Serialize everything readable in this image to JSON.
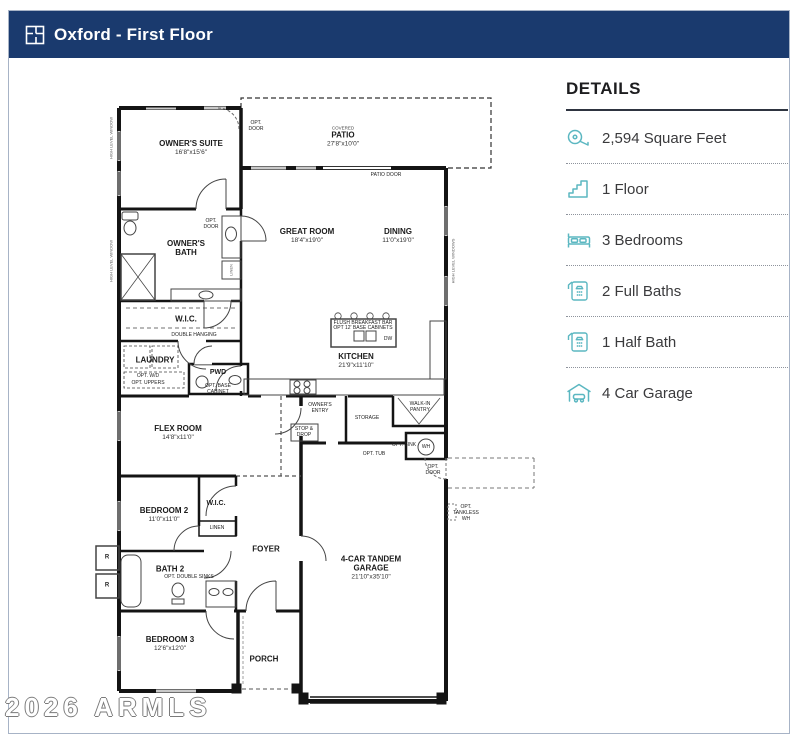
{
  "header": {
    "title": "Oxford - First Floor"
  },
  "details": {
    "heading": "DETAILS",
    "accent_color": "#5bb7c1",
    "items": [
      {
        "icon": "tape-measure-icon",
        "label": "2,594 Square Feet"
      },
      {
        "icon": "stairs-icon",
        "label": "1 Floor"
      },
      {
        "icon": "bed-icon",
        "label": "3 Bedrooms"
      },
      {
        "icon": "shower-icon",
        "label": "2 Full Baths"
      },
      {
        "icon": "shower-icon",
        "label": "1 Half Bath"
      },
      {
        "icon": "garage-icon",
        "label": "4 Car Garage"
      }
    ]
  },
  "floorplan": {
    "rooms": [
      {
        "name": "OWNER'S SUITE",
        "dims": "16'8\"x15'6\""
      },
      {
        "name": "PATIO",
        "dims": "27'8\"x10'0\"",
        "prefix": "COVERED"
      },
      {
        "name": "GREAT ROOM",
        "dims": "18'4\"x19'0\""
      },
      {
        "name": "DINING",
        "dims": "11'0\"x19'0\""
      },
      {
        "name": "OWNER'S BATH"
      },
      {
        "name": "W.I.C."
      },
      {
        "name": "LAUNDRY"
      },
      {
        "name": "PWD"
      },
      {
        "name": "KITCHEN",
        "dims": "21'9\"x11'10\""
      },
      {
        "name": "FLEX ROOM",
        "dims": "14'8\"x11'0\""
      },
      {
        "name": "BEDROOM 2",
        "dims": "11'0\"x11'0\""
      },
      {
        "name": "W.I.C."
      },
      {
        "name": "BATH 2"
      },
      {
        "name": "FOYER"
      },
      {
        "name": "BEDROOM 3",
        "dims": "12'6\"x12'0\""
      },
      {
        "name": "PORCH"
      },
      {
        "name": "4-CAR TANDEM GARAGE",
        "dims": "21'10\"x35'10\""
      }
    ],
    "annotations": [
      "PATIO DOOR",
      "OWNER'S ENTRY",
      "STORAGE",
      "WALK-IN PANTRY",
      "STOP & DROP",
      "DOUBLE HANGING",
      "LINEN",
      "LINEN",
      "OPT. DOUBLE SINKS",
      "FLUSH BREAKFAST BAR",
      "OPT 12' BASE CABINETS",
      "DW",
      "WH",
      "OPT. DOOR",
      "OPT. DOOR",
      "OPT. DOOR",
      "OPT. SINK",
      "OPT. TUB",
      "OPT. TANKLESS WH",
      "OPT. W/D",
      "OPT. UPPERS",
      "OPT. BASE CABINET",
      "R",
      "R",
      "HIGH LEVEL WINDOW",
      "HIGH LEVEL WINDOW",
      "HIGH LEVEL WINDOWS"
    ],
    "watermark": "2026 ARMLS"
  }
}
